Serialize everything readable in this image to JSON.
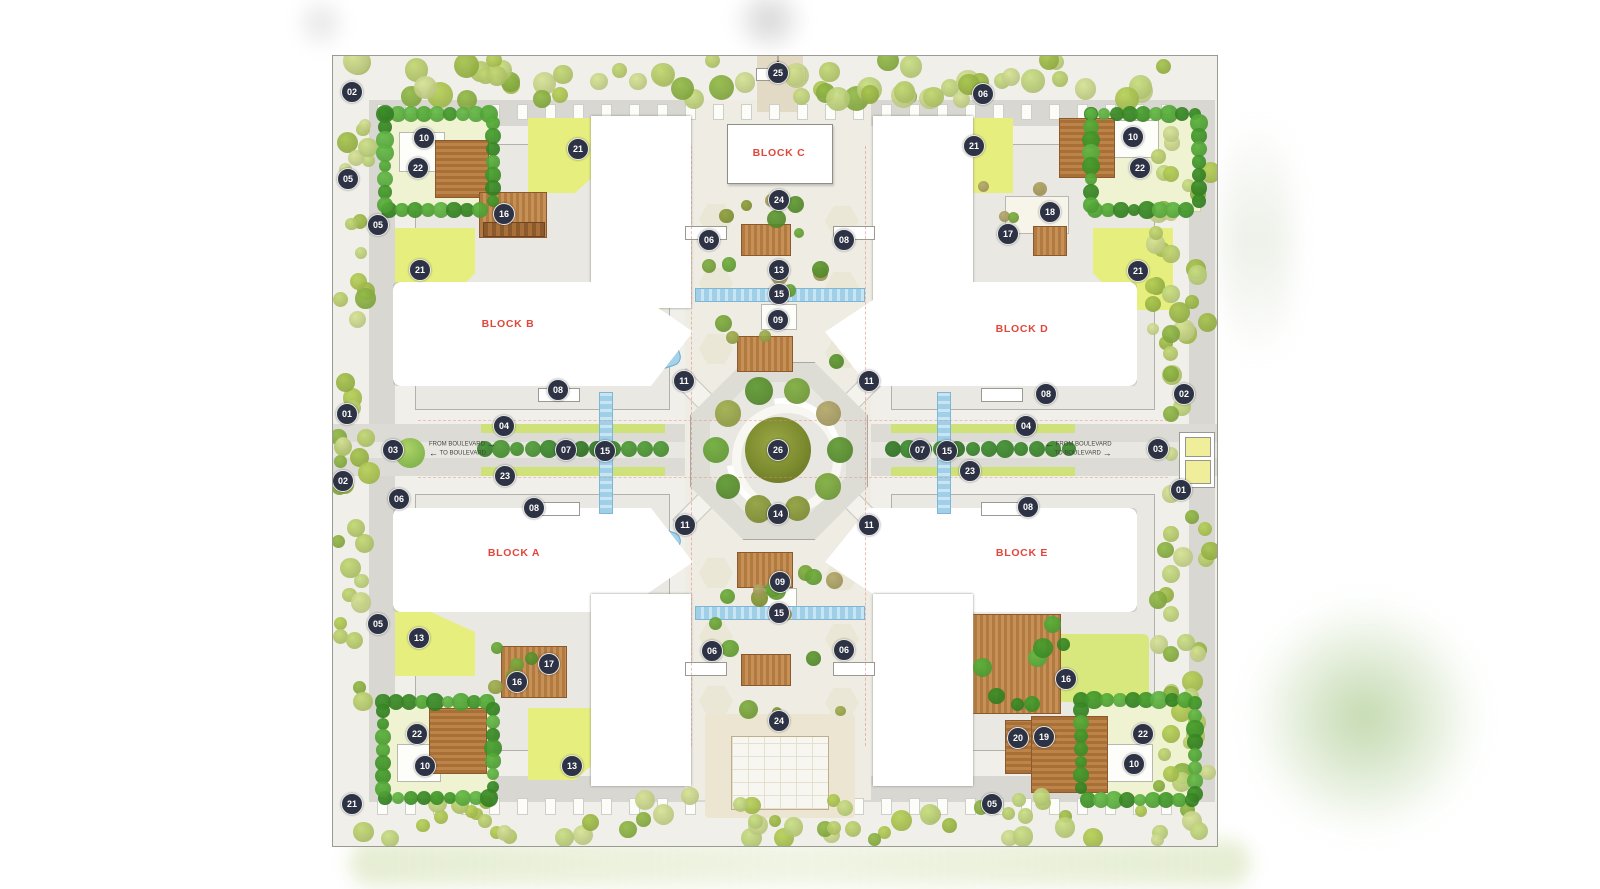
{
  "figure": {
    "kind": "architectural site master plan",
    "background": "#ffffff"
  },
  "plan": {
    "blocks": [
      {
        "id": "c",
        "label": "BLOCK C",
        "x": 446,
        "y": 97
      },
      {
        "id": "b",
        "label": "BLOCK B",
        "x": 175,
        "y": 268
      },
      {
        "id": "d",
        "label": "BLOCK D",
        "x": 689,
        "y": 273
      },
      {
        "id": "a",
        "label": "BLOCK A",
        "x": 181,
        "y": 497
      },
      {
        "id": "e",
        "label": "BLOCK E",
        "x": 689,
        "y": 497
      }
    ],
    "markers": [
      {
        "n": "25",
        "x": 445,
        "y": 17
      },
      {
        "n": "02",
        "x": 19,
        "y": 36
      },
      {
        "n": "06",
        "x": 650,
        "y": 38
      },
      {
        "n": "10",
        "x": 91,
        "y": 82
      },
      {
        "n": "21",
        "x": 245,
        "y": 93
      },
      {
        "n": "21",
        "x": 641,
        "y": 90
      },
      {
        "n": "10",
        "x": 800,
        "y": 81
      },
      {
        "n": "22",
        "x": 85,
        "y": 112
      },
      {
        "n": "22",
        "x": 807,
        "y": 112
      },
      {
        "n": "05",
        "x": 15,
        "y": 123
      },
      {
        "n": "24",
        "x": 446,
        "y": 144
      },
      {
        "n": "16",
        "x": 171,
        "y": 158
      },
      {
        "n": "18",
        "x": 717,
        "y": 156
      },
      {
        "n": "17",
        "x": 675,
        "y": 178
      },
      {
        "n": "05",
        "x": 45,
        "y": 169
      },
      {
        "n": "06",
        "x": 376,
        "y": 184
      },
      {
        "n": "08",
        "x": 511,
        "y": 184
      },
      {
        "n": "21",
        "x": 87,
        "y": 214
      },
      {
        "n": "21",
        "x": 805,
        "y": 215
      },
      {
        "n": "13",
        "x": 446,
        "y": 214
      },
      {
        "n": "15",
        "x": 446,
        "y": 238
      },
      {
        "n": "09",
        "x": 445,
        "y": 264
      },
      {
        "n": "11",
        "x": 351,
        "y": 325
      },
      {
        "n": "11",
        "x": 536,
        "y": 325
      },
      {
        "n": "08",
        "x": 225,
        "y": 334
      },
      {
        "n": "08",
        "x": 713,
        "y": 338
      },
      {
        "n": "02",
        "x": 851,
        "y": 338
      },
      {
        "n": "01",
        "x": 14,
        "y": 358
      },
      {
        "n": "04",
        "x": 171,
        "y": 370
      },
      {
        "n": "04",
        "x": 693,
        "y": 370
      },
      {
        "n": "03",
        "x": 60,
        "y": 394
      },
      {
        "n": "07",
        "x": 233,
        "y": 394
      },
      {
        "n": "15",
        "x": 272,
        "y": 395
      },
      {
        "n": "26",
        "x": 445,
        "y": 394
      },
      {
        "n": "07",
        "x": 587,
        "y": 394
      },
      {
        "n": "15",
        "x": 614,
        "y": 395
      },
      {
        "n": "03",
        "x": 825,
        "y": 393
      },
      {
        "n": "23",
        "x": 172,
        "y": 420
      },
      {
        "n": "23",
        "x": 637,
        "y": 415
      },
      {
        "n": "02",
        "x": 10,
        "y": 425
      },
      {
        "n": "01",
        "x": 848,
        "y": 434
      },
      {
        "n": "06",
        "x": 66,
        "y": 443
      },
      {
        "n": "08",
        "x": 201,
        "y": 452
      },
      {
        "n": "08",
        "x": 695,
        "y": 451
      },
      {
        "n": "14",
        "x": 445,
        "y": 458
      },
      {
        "n": "11",
        "x": 352,
        "y": 469
      },
      {
        "n": "11",
        "x": 536,
        "y": 469
      },
      {
        "n": "09",
        "x": 447,
        "y": 526
      },
      {
        "n": "15",
        "x": 446,
        "y": 557
      },
      {
        "n": "05",
        "x": 45,
        "y": 568
      },
      {
        "n": "13",
        "x": 86,
        "y": 582
      },
      {
        "n": "06",
        "x": 379,
        "y": 595
      },
      {
        "n": "06",
        "x": 511,
        "y": 594
      },
      {
        "n": "17",
        "x": 216,
        "y": 608
      },
      {
        "n": "16",
        "x": 184,
        "y": 626
      },
      {
        "n": "16",
        "x": 733,
        "y": 623
      },
      {
        "n": "24",
        "x": 446,
        "y": 665
      },
      {
        "n": "22",
        "x": 84,
        "y": 678
      },
      {
        "n": "22",
        "x": 810,
        "y": 678
      },
      {
        "n": "20",
        "x": 685,
        "y": 682
      },
      {
        "n": "19",
        "x": 711,
        "y": 681
      },
      {
        "n": "10",
        "x": 92,
        "y": 710
      },
      {
        "n": "13",
        "x": 239,
        "y": 710
      },
      {
        "n": "10",
        "x": 801,
        "y": 708
      },
      {
        "n": "05",
        "x": 659,
        "y": 748
      },
      {
        "n": "21",
        "x": 19,
        "y": 748
      }
    ],
    "entries": {
      "north": {
        "arrow": "↓"
      },
      "west": {
        "in": "FROM BOULEVARD",
        "in_arrow": "→",
        "out": "TO BOULEVARD",
        "out_arrow": "←"
      },
      "east": {
        "in": "FROM BOULEVARD",
        "in_arrow": "←",
        "out": "TO BOULEVARD",
        "out_arrow": "→"
      }
    },
    "colors": {
      "marker_bg": "#2d3344",
      "marker_text": "#ffffff",
      "block_label": "#e2473c",
      "water": "#a3d2ea",
      "lawn": "#e6ee7d",
      "road": "#dcdbd5",
      "paving": "#eeece3",
      "tree_bright": "#54ad35",
      "tree_band": "#b7d156",
      "tree_olive": "#8fa03a",
      "deck_brown": "#b07a40"
    }
  }
}
